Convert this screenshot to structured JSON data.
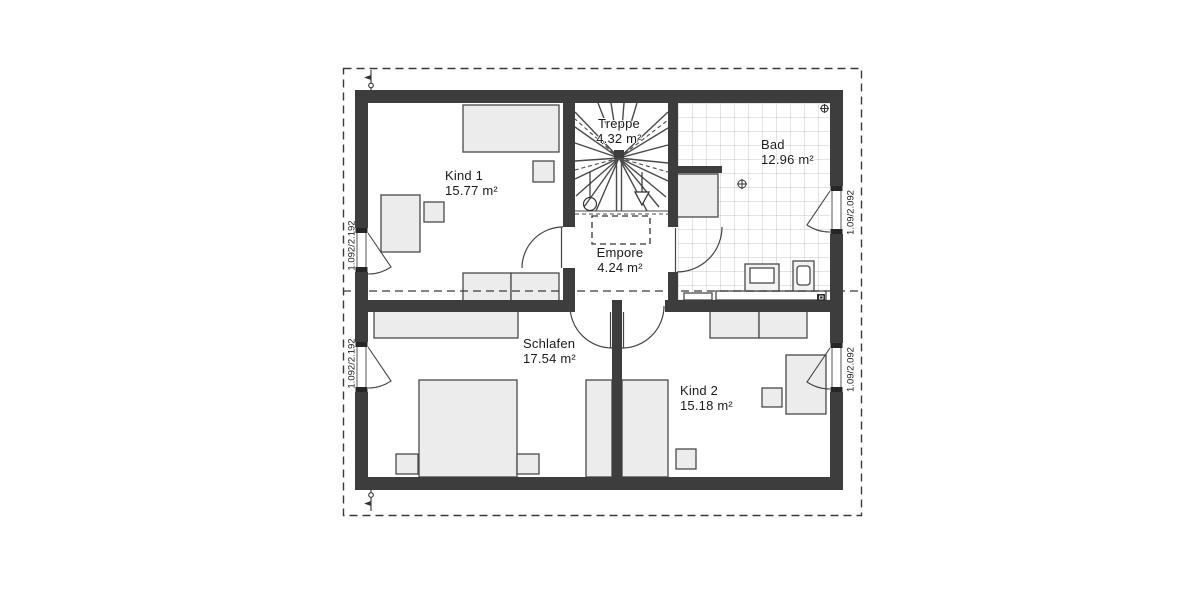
{
  "plan": {
    "rooms": [
      {
        "name": "Kind 1",
        "area": "15.77 m²"
      },
      {
        "name": "Treppe",
        "area": "4.32 m²"
      },
      {
        "name": "Bad",
        "area": "12.96 m²"
      },
      {
        "name": "Empore",
        "area": "4.24 m²"
      },
      {
        "name": "Schlafen",
        "area": "17.54 m²"
      },
      {
        "name": "Kind 2",
        "area": "15.18 m²"
      }
    ],
    "window_labels": {
      "left": "1.092/2.192",
      "right": "1.09/2.092"
    },
    "colors": {
      "wall": "#3d3d3d",
      "furniture_fill": "#ececec",
      "furniture_stroke": "#4a4a4a",
      "tile_grid": "#c8c8c8",
      "outline": "#3a3a3a"
    }
  }
}
